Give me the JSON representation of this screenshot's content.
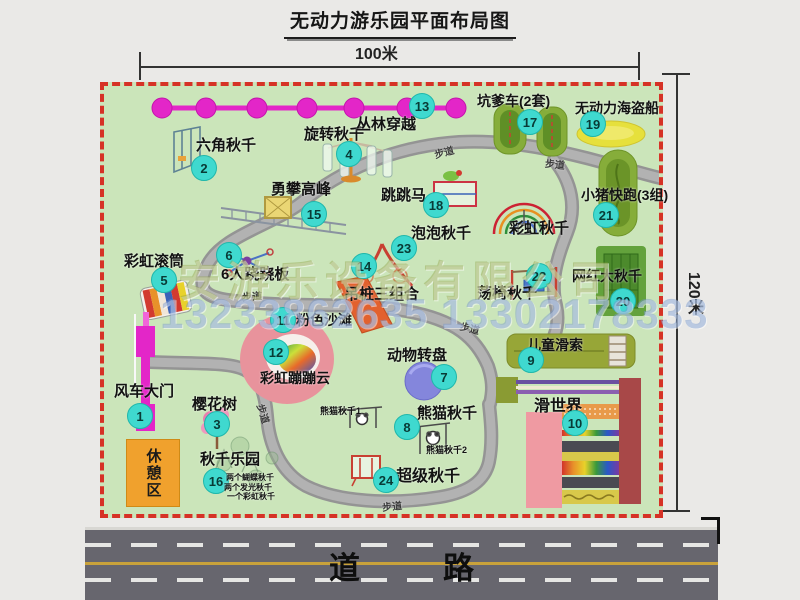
{
  "title": "无动力游乐园平面布局图",
  "dimensions": {
    "top": "100米",
    "right": "120米"
  },
  "road": {
    "label": "道　路"
  },
  "watermark": {
    "company": "安游乐设备有限公司",
    "phone": "13233862635 13302178333"
  },
  "colors": {
    "map_fill": "#cbe5ba",
    "map_border": "#d63226",
    "badge": "#3fd9cf",
    "rest_orange": "#f0a12d",
    "road_asphalt": "#67666e",
    "road_yellow": "#c9a23b",
    "zipline_pink": "#e326c8",
    "gate_magenta": "#e326c8"
  },
  "map": {
    "markers": [
      {
        "num": "1",
        "key": "windmill-gate",
        "label": "风车大门",
        "label_pos": [
          10,
          298
        ],
        "badge_pos": [
          36,
          330
        ],
        "size": 15
      },
      {
        "num": "2",
        "key": "hexagon-swing",
        "label": "六角秋千",
        "label_pos": [
          92,
          52
        ],
        "badge_pos": [
          100,
          82
        ],
        "size": 15
      },
      {
        "num": "3",
        "key": "cherry-tree",
        "label": "樱花树",
        "label_pos": [
          88,
          311
        ],
        "badge_pos": [
          113,
          338
        ],
        "size": 15
      },
      {
        "num": "4",
        "key": "rotating-swing",
        "label": "旋转秋千",
        "label_pos": [
          200,
          41
        ],
        "badge_pos": [
          245,
          68
        ],
        "size": 15
      },
      {
        "num": "5",
        "key": "rainbow-roller",
        "label": "彩虹滚筒",
        "label_pos": [
          20,
          168
        ],
        "badge_pos": [
          60,
          194
        ],
        "size": 15
      },
      {
        "num": "6",
        "key": "six-person-seesaw",
        "label": "6人跷跷板",
        "label_pos": [
          117,
          181
        ],
        "badge_pos": [
          125,
          169
        ],
        "size": 15
      },
      {
        "num": "7",
        "key": "animal-carousel",
        "label": "动物转盘",
        "label_pos": [
          283,
          262
        ],
        "badge_pos": [
          340,
          291
        ],
        "size": 15
      },
      {
        "num": "8",
        "key": "panda-swing",
        "label": "熊猫秋千",
        "label_pos": [
          313,
          320
        ],
        "badge_pos": [
          303,
          341
        ],
        "size": 15
      },
      {
        "num": "9",
        "key": "kids-zipline",
        "label": "儿童滑索",
        "label_pos": [
          423,
          252
        ],
        "badge_pos": [
          427,
          274
        ],
        "size": 14
      },
      {
        "num": "10",
        "key": "slide-world",
        "label": "滑世界",
        "label_pos": [
          430,
          313
        ],
        "badge_pos": [
          471,
          337
        ],
        "size": 16
      },
      {
        "num": "11",
        "key": "pink-beach",
        "label": "粉色沙滩",
        "label_pos": [
          192,
          227
        ],
        "badge_pos": [
          179,
          234
        ],
        "size": 14
      },
      {
        "num": "12",
        "key": "rainbow-bounce-cloud",
        "label": "彩虹蹦蹦云",
        "label_pos": [
          156,
          285
        ],
        "badge_pos": [
          172,
          266
        ],
        "size": 14
      },
      {
        "num": "13",
        "key": "jungle-crossing",
        "label": "丛林穿越",
        "label_pos": [
          252,
          31
        ],
        "badge_pos": [
          318,
          20
        ],
        "size": 15
      },
      {
        "num": "14",
        "key": "hanging-piles-combo",
        "label": "吊桩三组合",
        "label_pos": [
          240,
          201
        ],
        "badge_pos": [
          260,
          180
        ],
        "size": 15
      },
      {
        "num": "15",
        "key": "climbing-peak",
        "label": "勇攀高峰",
        "label_pos": [
          167,
          96
        ],
        "badge_pos": [
          210,
          128
        ],
        "size": 15
      },
      {
        "num": "16",
        "key": "swing-park",
        "label": "秋千乐园",
        "label_pos": [
          96,
          366
        ],
        "badge_pos": [
          112,
          395
        ],
        "size": 15
      },
      {
        "num": "17",
        "key": "bumper-cars",
        "label": "坑爹车(2套)",
        "label_pos": [
          373,
          8
        ],
        "badge_pos": [
          426,
          36
        ],
        "size": 14
      },
      {
        "num": "18",
        "key": "jumping-horse",
        "label": "跳跳马",
        "label_pos": [
          277,
          102
        ],
        "badge_pos": [
          332,
          119
        ],
        "size": 15
      },
      {
        "num": "19",
        "key": "pirate-ship",
        "label": "无动力海盗船",
        "label_pos": [
          471,
          15
        ],
        "badge_pos": [
          489,
          38
        ],
        "size": 14
      },
      {
        "num": "20",
        "key": "big-net-swing",
        "label": "网红大秋千",
        "label_pos": [
          468,
          183
        ],
        "badge_pos": [
          519,
          215
        ],
        "size": 14
      },
      {
        "num": "21",
        "key": "piggy-run",
        "label": "小猪快跑(3组)",
        "label_pos": [
          477,
          102
        ],
        "badge_pos": [
          502,
          129
        ],
        "size": 14
      },
      {
        "num": "22",
        "key": "swing-chair",
        "label": "荡椅秋千",
        "label_pos": [
          373,
          200
        ],
        "badge_pos": [
          435,
          190
        ],
        "size": 15
      },
      {
        "num": "23",
        "key": "bubble-swing",
        "label": "泡泡秋千",
        "label_pos": [
          307,
          140
        ],
        "badge_pos": [
          300,
          162
        ],
        "size": 15
      },
      {
        "num": "24",
        "key": "super-swing",
        "label": "超级秋千",
        "label_pos": [
          292,
          383
        ],
        "badge_pos": [
          282,
          394
        ],
        "size": 16
      }
    ],
    "extra_labels": [
      {
        "key": "rainbow-swing",
        "label": "彩虹秋千",
        "pos": [
          405,
          135
        ],
        "size": 15
      },
      {
        "key": "panda-swing-1",
        "label": "熊猫秋千1",
        "pos": [
          216,
          321
        ],
        "size": 9
      },
      {
        "key": "panda-swing-2",
        "label": "熊猫秋千2",
        "pos": [
          322,
          360
        ],
        "size": 9
      },
      {
        "key": "swing-park-note-1",
        "label": "两个蝴蝶秋千",
        "pos": [
          122,
          388
        ],
        "size": 8
      },
      {
        "key": "swing-park-note-2",
        "label": "两个发光秋千",
        "pos": [
          120,
          398
        ],
        "size": 8
      },
      {
        "key": "swing-park-note-3",
        "label": "一个彩虹秋千",
        "pos": [
          123,
          407
        ],
        "size": 8
      }
    ],
    "rest_area_label": "休憩区",
    "path_labels": [
      {
        "label": "步道",
        "pos": [
          330,
          58
        ],
        "rot": -15
      },
      {
        "label": "步道",
        "pos": [
          441,
          70
        ],
        "rot": 6
      },
      {
        "label": "步道",
        "pos": [
          138,
          202
        ],
        "rot": -4
      },
      {
        "label": "步道",
        "pos": [
          356,
          234
        ],
        "rot": 14
      },
      {
        "label": "步道",
        "pos": [
          150,
          320
        ],
        "rot": 73
      },
      {
        "label": "步道",
        "pos": [
          278,
          412
        ],
        "rot": -6
      }
    ]
  }
}
